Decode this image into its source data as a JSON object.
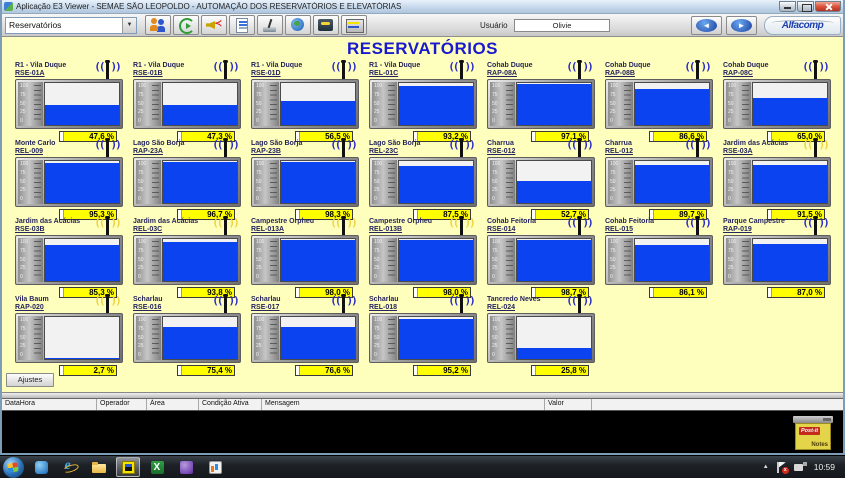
{
  "window": {
    "title": "Aplicação E3 Viewer - SEMAE SÃO LEOPOLDO - AUTOMAÇÃO DOS RESERVATÓRIOS E ELEVATÓRIAS"
  },
  "toolbar": {
    "screen_selector_value": "Reservatórios",
    "icons": [
      "users-icon",
      "refresh-icon",
      "alarm-speaker-icon",
      "report-icon",
      "radio-antenna-icon",
      "world-icon",
      "phone-panel-icon",
      "level-panel-icon"
    ],
    "user_label": "Usuário",
    "user_value": "Olivie",
    "brand": "Alfacomp"
  },
  "main": {
    "title": "RESERVATÓRIOS",
    "adjust_button_label": "Ajustes"
  },
  "gauge": {
    "scale_labels": [
      "100",
      "75",
      "50",
      "25",
      "0"
    ]
  },
  "reservoirs": [
    {
      "name": "R1 - Vila Duque",
      "code": "RSE-01A",
      "value": "47,6 %",
      "pct": 47.6,
      "antenna": "blue"
    },
    {
      "name": "R1 - Vila Duque",
      "code": "RSE-01B",
      "value": "47,3 %",
      "pct": 47.3,
      "antenna": "blue"
    },
    {
      "name": "R1 - Vila Duque",
      "code": "RSE-01D",
      "value": "56,5 %",
      "pct": 56.5,
      "antenna": "blue"
    },
    {
      "name": "R1 - Vila Duque",
      "code": "REL-01C",
      "value": "93,2 %",
      "pct": 93.2,
      "antenna": "blue"
    },
    {
      "name": "Cohab Duque",
      "code": "RAP-08A",
      "value": "97,1 %",
      "pct": 97.1,
      "antenna": "blue"
    },
    {
      "name": "Cohab Duque",
      "code": "RAP-08B",
      "value": "86,6 %",
      "pct": 86.6,
      "antenna": "blue"
    },
    {
      "name": "Cohab Duque",
      "code": "RAP-08C",
      "value": "65,0 %",
      "pct": 65.0,
      "antenna": "blue"
    },
    {
      "name": "Monte Carlo",
      "code": "REL-009",
      "value": "95,3 %",
      "pct": 95.3,
      "antenna": "blue"
    },
    {
      "name": "Lago São Borja",
      "code": "RAP-23A",
      "value": "96,7 %",
      "pct": 96.7,
      "antenna": "blue"
    },
    {
      "name": "Lago São Borja",
      "code": "RAP-23B",
      "value": "98,3 %",
      "pct": 98.3,
      "antenna": "blue"
    },
    {
      "name": "Lago São Borja",
      "code": "REL-23C",
      "value": "87,5 %",
      "pct": 87.5,
      "antenna": "blue"
    },
    {
      "name": "Charrua",
      "code": "RSE-012",
      "value": "52,7 %",
      "pct": 52.7,
      "antenna": "blue"
    },
    {
      "name": "Charrua",
      "code": "REL-012",
      "value": "89,7 %",
      "pct": 89.7,
      "antenna": "blue"
    },
    {
      "name": "Jardim das Acácias",
      "code": "RSE-03A",
      "value": "91,5 %",
      "pct": 91.5,
      "antenna": "yellow"
    },
    {
      "name": "Jardim das Acácias",
      "code": "RSE-03B",
      "value": "85,3 %",
      "pct": 85.3,
      "antenna": "yellow"
    },
    {
      "name": "Jardim das Acácias",
      "code": "REL-03C",
      "value": "93,8 %",
      "pct": 93.8,
      "antenna": "yellow"
    },
    {
      "name": "Campestre Orpheu",
      "code": "REL-013A",
      "value": "98,0 %",
      "pct": 98.0,
      "antenna": "yellow"
    },
    {
      "name": "Campestre Orpheu",
      "code": "REL-013B",
      "value": "98,0 %",
      "pct": 98.0,
      "antenna": "yellow"
    },
    {
      "name": "Cohab Feitoria",
      "code": "RSE-014",
      "value": "98,7 %",
      "pct": 98.7,
      "antenna": "blue"
    },
    {
      "name": "Cohab Feitoria",
      "code": "REL-015",
      "value": "86,1 %",
      "pct": 86.1,
      "antenna": "blue"
    },
    {
      "name": "Parque Campestre",
      "code": "RAP-019",
      "value": "87,0 %",
      "pct": 87.0,
      "antenna": "blue"
    },
    {
      "name": "Vila Baum",
      "code": "RAP-020",
      "value": "2,7 %",
      "pct": 2.7,
      "antenna": "yellow"
    },
    {
      "name": "Scharlau",
      "code": "RSE-016",
      "value": "75,4 %",
      "pct": 75.4,
      "antenna": "blue"
    },
    {
      "name": "Scharlau",
      "code": "RSE-017",
      "value": "76,6 %",
      "pct": 76.6,
      "antenna": "blue"
    },
    {
      "name": "Scharlau",
      "code": "REL-018",
      "value": "95,2 %",
      "pct": 95.2,
      "antenna": "blue"
    },
    {
      "name": "Tancredo Neves",
      "code": "REL-024",
      "value": "25,8 %",
      "pct": 25.8,
      "antenna": "blue"
    }
  ],
  "alarm_table": {
    "columns": [
      "DataHora",
      "Operador",
      "Área",
      "Condição Ativa",
      "Mensagem",
      "Valor"
    ]
  },
  "notes_icon": {
    "line1": "Post-it",
    "line2": "Notes"
  },
  "taskbar": {
    "time": "10:59"
  },
  "colors": {
    "main_background": "#ffffbd",
    "tank_fill_blue": "#0b43f0",
    "value_box_yellow": "#ffff00",
    "title_blue": "#1919cf",
    "antenna_blue": "#2a2acc",
    "antenna_alarm_yellow": "#eed23f"
  }
}
